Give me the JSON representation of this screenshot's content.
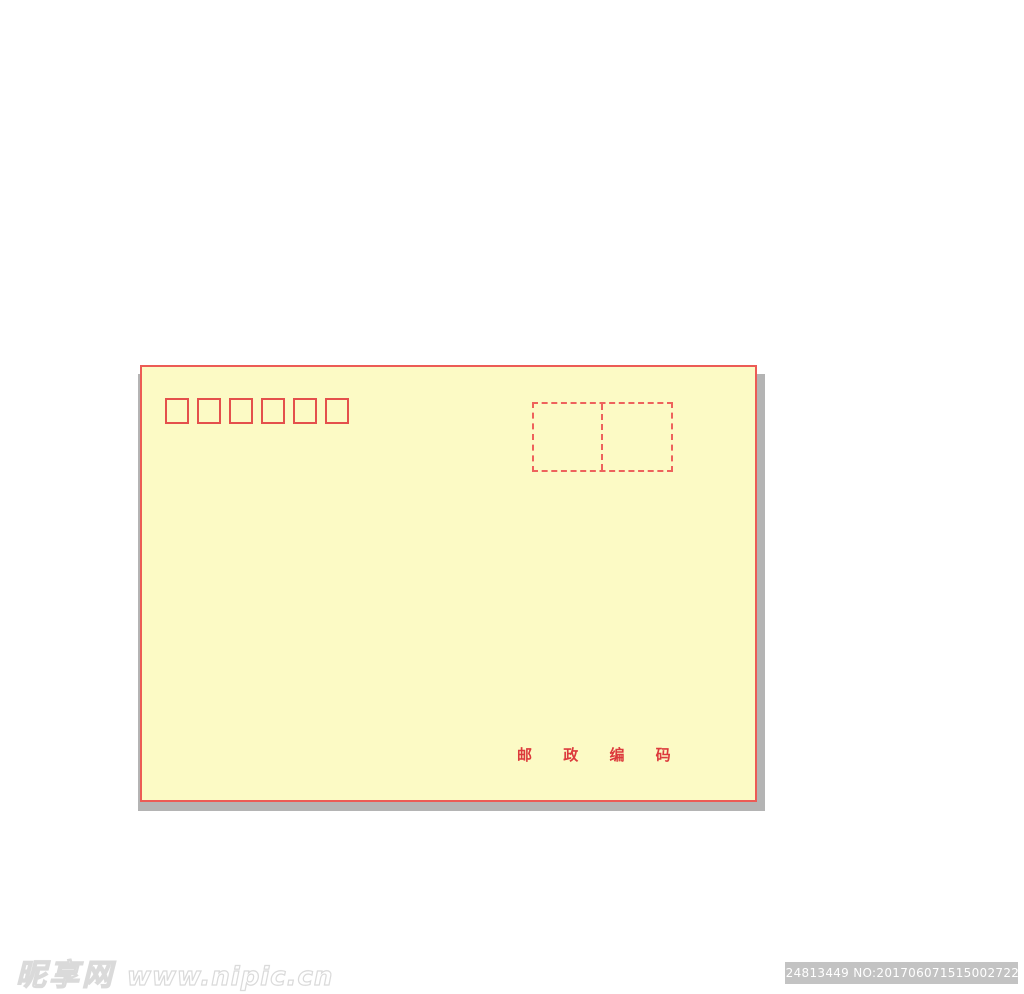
{
  "envelope": {
    "fill_color": "#fcfac5",
    "border_color": "#ec5b55",
    "shadow_color": "#b4b4b4",
    "accent_red": "#e4504c",
    "postal_code_boxes": {
      "count": 6
    },
    "stamp_area": {
      "compartments": 2
    },
    "postal_code_label": "邮 政 编 码",
    "label_color": "#dc3a3c"
  },
  "watermark": {
    "site_name": "昵享网",
    "site_url": "www.nipic.cn"
  },
  "id_bar": {
    "text": "ID:24813449 NO:20170607151500272290",
    "background": "#c3c3c3",
    "text_color": "#ffffff"
  }
}
